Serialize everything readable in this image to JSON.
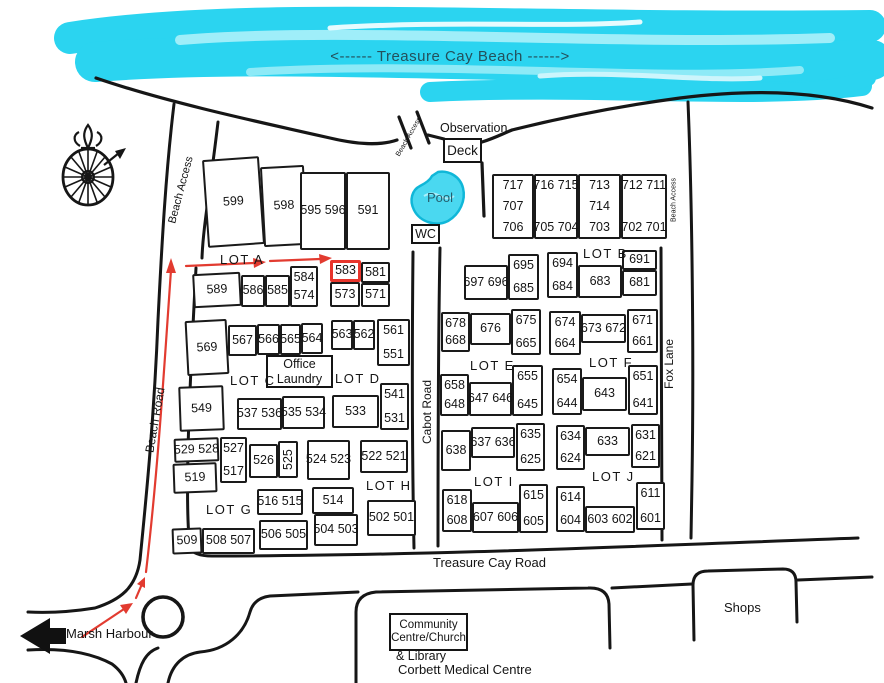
{
  "canvas": {
    "w": 884,
    "h": 683
  },
  "colors": {
    "beach": "#2bd4f0",
    "beach_light": "#9feef9",
    "pool_fill": "#4ad8f0",
    "pool_stroke": "#10b7d8",
    "road": "#161616",
    "red_arrow": "#e23b30",
    "highlight": "#e8352c",
    "text": "#141414",
    "beach_text": "#24505b"
  },
  "labels": {
    "beach_title": "<------ Treasure Cay Beach ------>",
    "observation": "Observation",
    "pool": "Pool",
    "treasure_cay_road": "Treasure Cay Road",
    "marsh_harbour": "Marsh Harbour",
    "shops": "Shops",
    "library": "& Library",
    "corbett": "Corbett Medical Centre"
  },
  "road_labels": [
    {
      "t": "Beach Access",
      "x": 181,
      "y": 190,
      "rot": -75,
      "size": 11
    },
    {
      "t": "Beach Road",
      "x": 155,
      "y": 420,
      "rot": -80,
      "size": 12
    },
    {
      "t": "Cabot Road",
      "x": 427,
      "y": 412,
      "rot": -90,
      "size": 12
    },
    {
      "t": "Fox Lane",
      "x": 669,
      "y": 364,
      "rot": -90,
      "size": 12
    },
    {
      "t": "Beach Access",
      "x": 409,
      "y": 137,
      "rot": -60,
      "size": 7
    },
    {
      "t": "Beach Access",
      "x": 674,
      "y": 200,
      "rot": -90,
      "size": 7
    }
  ],
  "lot_labels": [
    {
      "t": "LOT A",
      "x": 220,
      "y": 252
    },
    {
      "t": "LOT B",
      "x": 583,
      "y": 246
    },
    {
      "t": "LOT C",
      "x": 230,
      "y": 373
    },
    {
      "t": "LOT D",
      "x": 335,
      "y": 371
    },
    {
      "t": "LOT E",
      "x": 470,
      "y": 358
    },
    {
      "t": "LOT F",
      "x": 589,
      "y": 355
    },
    {
      "t": "LOT G",
      "x": 206,
      "y": 502
    },
    {
      "t": "LOT H",
      "x": 366,
      "y": 478
    },
    {
      "t": "LOT I",
      "x": 474,
      "y": 474
    },
    {
      "t": "LOT J",
      "x": 592,
      "y": 469
    }
  ],
  "buildings": [
    {
      "name": "deck",
      "lines": [
        "Deck"
      ],
      "x": 443,
      "y": 138,
      "w": 39,
      "h": 25,
      "size": 13.5
    },
    {
      "name": "wc",
      "lines": [
        "WC"
      ],
      "x": 411,
      "y": 224,
      "w": 29,
      "h": 20,
      "size": 12.5
    },
    {
      "name": "office-laundry",
      "lines": [
        "Office",
        "Laundry"
      ],
      "x": 266,
      "y": 355,
      "w": 67,
      "h": 33,
      "size": 12.5
    },
    {
      "name": "community-centre",
      "lines": [
        "Community",
        "Centre/Church"
      ],
      "x": 389,
      "y": 613,
      "w": 79,
      "h": 38,
      "size": 11.5
    }
  ],
  "lots": [
    {
      "lines": [
        "599"
      ],
      "x": 205,
      "y": 158,
      "w": 57,
      "h": 88,
      "r": -4
    },
    {
      "lines": [
        "598"
      ],
      "x": 262,
      "y": 166,
      "w": 44,
      "h": 80,
      "r": -3
    },
    {
      "lines": [
        "595 596"
      ],
      "x": 300,
      "y": 172,
      "w": 46,
      "h": 78
    },
    {
      "lines": [
        "591"
      ],
      "x": 346,
      "y": 172,
      "w": 44,
      "h": 78
    },
    {
      "lines": [
        "717",
        "707",
        "706"
      ],
      "x": 492,
      "y": 174,
      "w": 42,
      "h": 65
    },
    {
      "lines": [
        "716 715",
        "705 704"
      ],
      "x": 534,
      "y": 174,
      "w": 44,
      "h": 65
    },
    {
      "lines": [
        "713",
        "714",
        "703"
      ],
      "x": 578,
      "y": 174,
      "w": 43,
      "h": 65
    },
    {
      "lines": [
        "712 711",
        "702 701"
      ],
      "x": 621,
      "y": 174,
      "w": 46,
      "h": 65
    },
    {
      "lines": [
        "589"
      ],
      "x": 193,
      "y": 273,
      "w": 48,
      "h": 34,
      "r": -3
    },
    {
      "lines": [
        "586"
      ],
      "x": 241,
      "y": 275,
      "w": 24,
      "h": 32
    },
    {
      "lines": [
        "585"
      ],
      "x": 265,
      "y": 275,
      "w": 25,
      "h": 32
    },
    {
      "lines": [
        "584",
        "574"
      ],
      "x": 290,
      "y": 266,
      "w": 28,
      "h": 41
    },
    {
      "lines": [
        "583"
      ],
      "x": 330,
      "y": 260,
      "w": 31,
      "h": 22,
      "red": true
    },
    {
      "lines": [
        "573"
      ],
      "x": 330,
      "y": 282,
      "w": 30,
      "h": 25
    },
    {
      "lines": [
        "581"
      ],
      "x": 361,
      "y": 262,
      "w": 29,
      "h": 21
    },
    {
      "lines": [
        "571"
      ],
      "x": 361,
      "y": 283,
      "w": 29,
      "h": 24
    },
    {
      "lines": [
        "697 696"
      ],
      "x": 464,
      "y": 265,
      "w": 44,
      "h": 35
    },
    {
      "lines": [
        "695",
        "685"
      ],
      "x": 508,
      "y": 254,
      "w": 31,
      "h": 46
    },
    {
      "lines": [
        "694",
        "684"
      ],
      "x": 547,
      "y": 252,
      "w": 31,
      "h": 46
    },
    {
      "lines": [
        "683"
      ],
      "x": 578,
      "y": 265,
      "w": 44,
      "h": 33
    },
    {
      "lines": [
        "691"
      ],
      "x": 622,
      "y": 250,
      "w": 35,
      "h": 20
    },
    {
      "lines": [
        "681"
      ],
      "x": 622,
      "y": 270,
      "w": 35,
      "h": 26
    },
    {
      "lines": [
        "678",
        "668"
      ],
      "x": 441,
      "y": 312,
      "w": 29,
      "h": 40
    },
    {
      "lines": [
        "676"
      ],
      "x": 470,
      "y": 313,
      "w": 41,
      "h": 32
    },
    {
      "lines": [
        "675",
        "665"
      ],
      "x": 511,
      "y": 309,
      "w": 30,
      "h": 46
    },
    {
      "lines": [
        "674",
        "664"
      ],
      "x": 549,
      "y": 311,
      "w": 32,
      "h": 44
    },
    {
      "lines": [
        "673 672"
      ],
      "x": 581,
      "y": 314,
      "w": 45,
      "h": 29
    },
    {
      "lines": [
        "671",
        "661"
      ],
      "x": 627,
      "y": 309,
      "w": 31,
      "h": 44
    },
    {
      "lines": [
        "658",
        "648"
      ],
      "x": 440,
      "y": 374,
      "w": 29,
      "h": 42
    },
    {
      "lines": [
        "647 646"
      ],
      "x": 469,
      "y": 382,
      "w": 43,
      "h": 34
    },
    {
      "lines": [
        "655",
        "645"
      ],
      "x": 512,
      "y": 365,
      "w": 31,
      "h": 51
    },
    {
      "lines": [
        "654",
        "644"
      ],
      "x": 552,
      "y": 368,
      "w": 30,
      "h": 47
    },
    {
      "lines": [
        "643"
      ],
      "x": 582,
      "y": 377,
      "w": 45,
      "h": 34
    },
    {
      "lines": [
        "651",
        "641"
      ],
      "x": 628,
      "y": 365,
      "w": 30,
      "h": 50
    },
    {
      "lines": [
        "638"
      ],
      "x": 441,
      "y": 430,
      "w": 30,
      "h": 41
    },
    {
      "lines": [
        "637 636"
      ],
      "x": 471,
      "y": 427,
      "w": 44,
      "h": 31
    },
    {
      "lines": [
        "635",
        "625"
      ],
      "x": 516,
      "y": 423,
      "w": 29,
      "h": 48
    },
    {
      "lines": [
        "634",
        "624"
      ],
      "x": 556,
      "y": 425,
      "w": 29,
      "h": 45
    },
    {
      "lines": [
        "633"
      ],
      "x": 585,
      "y": 427,
      "w": 45,
      "h": 29
    },
    {
      "lines": [
        "631",
        "621"
      ],
      "x": 631,
      "y": 424,
      "w": 29,
      "h": 44
    },
    {
      "lines": [
        "618",
        "608"
      ],
      "x": 442,
      "y": 489,
      "w": 30,
      "h": 43
    },
    {
      "lines": [
        "607 606"
      ],
      "x": 472,
      "y": 502,
      "w": 47,
      "h": 31
    },
    {
      "lines": [
        "615",
        "605"
      ],
      "x": 519,
      "y": 484,
      "w": 29,
      "h": 49
    },
    {
      "lines": [
        "614",
        "604"
      ],
      "x": 556,
      "y": 486,
      "w": 29,
      "h": 46
    },
    {
      "lines": [
        "603 602"
      ],
      "x": 585,
      "y": 506,
      "w": 50,
      "h": 27
    },
    {
      "lines": [
        "611",
        "601"
      ],
      "x": 636,
      "y": 482,
      "w": 29,
      "h": 48
    },
    {
      "lines": [
        "569"
      ],
      "x": 186,
      "y": 320,
      "w": 42,
      "h": 55,
      "r": -3
    },
    {
      "lines": [
        "567"
      ],
      "x": 228,
      "y": 325,
      "w": 29,
      "h": 31
    },
    {
      "lines": [
        "566"
      ],
      "x": 257,
      "y": 324,
      "w": 23,
      "h": 31
    },
    {
      "lines": [
        "565"
      ],
      "x": 280,
      "y": 324,
      "w": 21,
      "h": 31
    },
    {
      "lines": [
        "564"
      ],
      "x": 301,
      "y": 323,
      "w": 22,
      "h": 31
    },
    {
      "lines": [
        "563"
      ],
      "x": 331,
      "y": 320,
      "w": 22,
      "h": 30
    },
    {
      "lines": [
        "562"
      ],
      "x": 353,
      "y": 320,
      "w": 22,
      "h": 30
    },
    {
      "lines": [
        "561",
        "551"
      ],
      "x": 377,
      "y": 319,
      "w": 33,
      "h": 47
    },
    {
      "lines": [
        "549"
      ],
      "x": 179,
      "y": 386,
      "w": 45,
      "h": 45,
      "r": -2
    },
    {
      "lines": [
        "537 536"
      ],
      "x": 237,
      "y": 398,
      "w": 45,
      "h": 32
    },
    {
      "lines": [
        "535 534"
      ],
      "x": 282,
      "y": 396,
      "w": 43,
      "h": 33
    },
    {
      "lines": [
        "533"
      ],
      "x": 332,
      "y": 395,
      "w": 47,
      "h": 33
    },
    {
      "lines": [
        "541",
        "531"
      ],
      "x": 380,
      "y": 383,
      "w": 29,
      "h": 47
    },
    {
      "lines": [
        "529 528"
      ],
      "x": 174,
      "y": 438,
      "w": 45,
      "h": 24,
      "r": -2
    },
    {
      "lines": [
        "519"
      ],
      "x": 173,
      "y": 463,
      "w": 44,
      "h": 30,
      "r": -2
    },
    {
      "lines": [
        "527",
        "517"
      ],
      "x": 220,
      "y": 437,
      "w": 27,
      "h": 46
    },
    {
      "lines": [
        "526"
      ],
      "x": 249,
      "y": 444,
      "w": 29,
      "h": 34
    },
    {
      "lines": [
        "525"
      ],
      "x": 278,
      "y": 441,
      "w": 20,
      "h": 37,
      "vert": true
    },
    {
      "lines": [
        "524 523"
      ],
      "x": 307,
      "y": 440,
      "w": 43,
      "h": 40
    },
    {
      "lines": [
        "522 521"
      ],
      "x": 360,
      "y": 440,
      "w": 48,
      "h": 33
    },
    {
      "lines": [
        "516 515"
      ],
      "x": 257,
      "y": 489,
      "w": 46,
      "h": 26
    },
    {
      "lines": [
        "514"
      ],
      "x": 312,
      "y": 487,
      "w": 42,
      "h": 27
    },
    {
      "lines": [
        "506 505"
      ],
      "x": 259,
      "y": 520,
      "w": 49,
      "h": 30
    },
    {
      "lines": [
        "504 503"
      ],
      "x": 314,
      "y": 514,
      "w": 44,
      "h": 32
    },
    {
      "lines": [
        "502 501"
      ],
      "x": 367,
      "y": 500,
      "w": 49,
      "h": 36
    },
    {
      "lines": [
        "509"
      ],
      "x": 172,
      "y": 528,
      "w": 30,
      "h": 26,
      "r": -2
    },
    {
      "lines": [
        "508 507"
      ],
      "x": 202,
      "y": 528,
      "w": 53,
      "h": 26
    }
  ]
}
